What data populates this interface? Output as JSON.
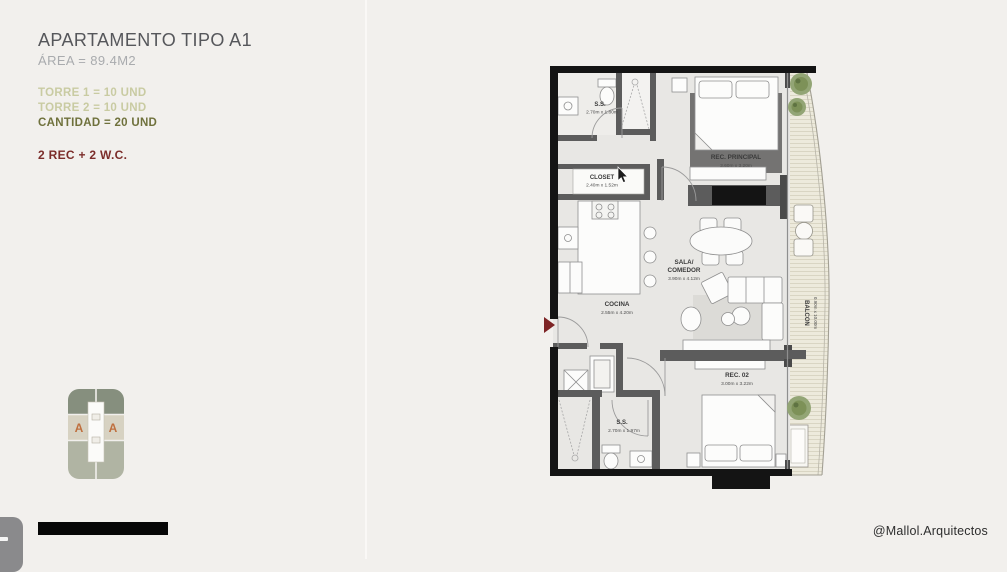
{
  "panel": {
    "title": "APARTAMENTO TIPO A1",
    "area": "ÁREA = 89.4M2",
    "torre1": "TORRE 1 = 10 UND",
    "torre2": "TORRE 2 = 10 UND",
    "cantidad": "CANTIDAD = 20 UND",
    "program": "2 REC + 2 W.C."
  },
  "key_plan": {
    "unit_left": "A",
    "unit_right": "A"
  },
  "plan": {
    "ss_top": {
      "name": "S.S.",
      "dims": "2.70m x 1.80m"
    },
    "rec_principal": {
      "name": "REC. PRINCIPAL",
      "dims": "3.60m x 3.20m"
    },
    "closet": {
      "name": "CLOSET",
      "dims": "2.40m x 1.52m"
    },
    "sala": {
      "name_line1": "SALA/",
      "name_line2": "COMEDOR",
      "dims": "3.90m x 4.12m"
    },
    "cocina": {
      "name": "COCINA",
      "dims": "2.55m x 4.20m"
    },
    "rec_02": {
      "name": "REC. 02",
      "dims": "3.00m x 3.22m"
    },
    "ss_bottom": {
      "name": "S.S.",
      "dims": "2.70m x 1.97m"
    },
    "balcon": {
      "name": "BALCON",
      "dims": "0.90m x 10.00m"
    }
  },
  "footer": {
    "credit": "@Mallol.Arquitectos"
  },
  "colors": {
    "title_gray": "#56575b",
    "muted_gray": "#a9abae",
    "olive_light": "#c9cba2",
    "olive_dark": "#6f713c",
    "accent_maroon": "#7c2d2a",
    "plant_green": "#8ba06b",
    "unit_letter_orange": "#bf6f3e"
  }
}
